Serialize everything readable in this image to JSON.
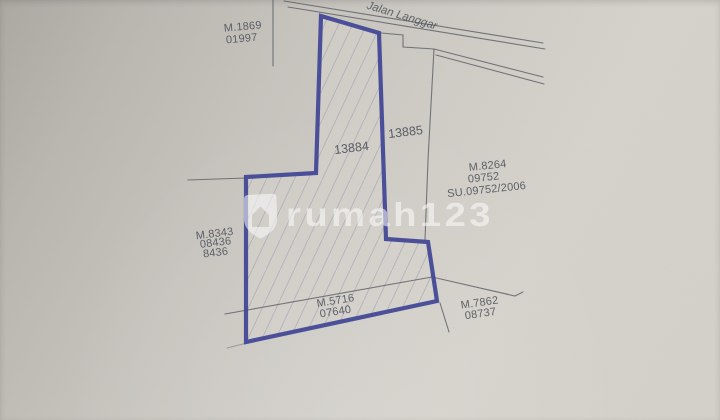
{
  "scene": {
    "description": "Scanned cadastral land survey plan photo",
    "road": {
      "label": "Jalan Langgar"
    },
    "parcel_numbers": {
      "main": "13884",
      "adjacent": "13885"
    },
    "labels": {
      "northwest": {
        "line1": "M.1869",
        "line2": "01997"
      },
      "east": {
        "line1": "M.8264",
        "line2": "09752",
        "line3": "SU.09752/2006"
      },
      "west": {
        "line1": "M.8343",
        "line2": "08436",
        "line3": "8436"
      },
      "south_strip": {
        "line1": "M.5716",
        "line2": "07640"
      },
      "southeast": {
        "line1": "M.7862",
        "line2": "08737"
      }
    },
    "watermark": {
      "text": "rumah123",
      "logo": "rumah123-shield-house-logo"
    },
    "colors": {
      "parcel_outline": "#3d4194",
      "survey_line": "#575b63",
      "label_text": "#494e58",
      "hatch": "#9299ad",
      "paper_dark": "#aba7a1",
      "paper_light": "#d5d2cb",
      "watermark": "#ffffff"
    }
  }
}
